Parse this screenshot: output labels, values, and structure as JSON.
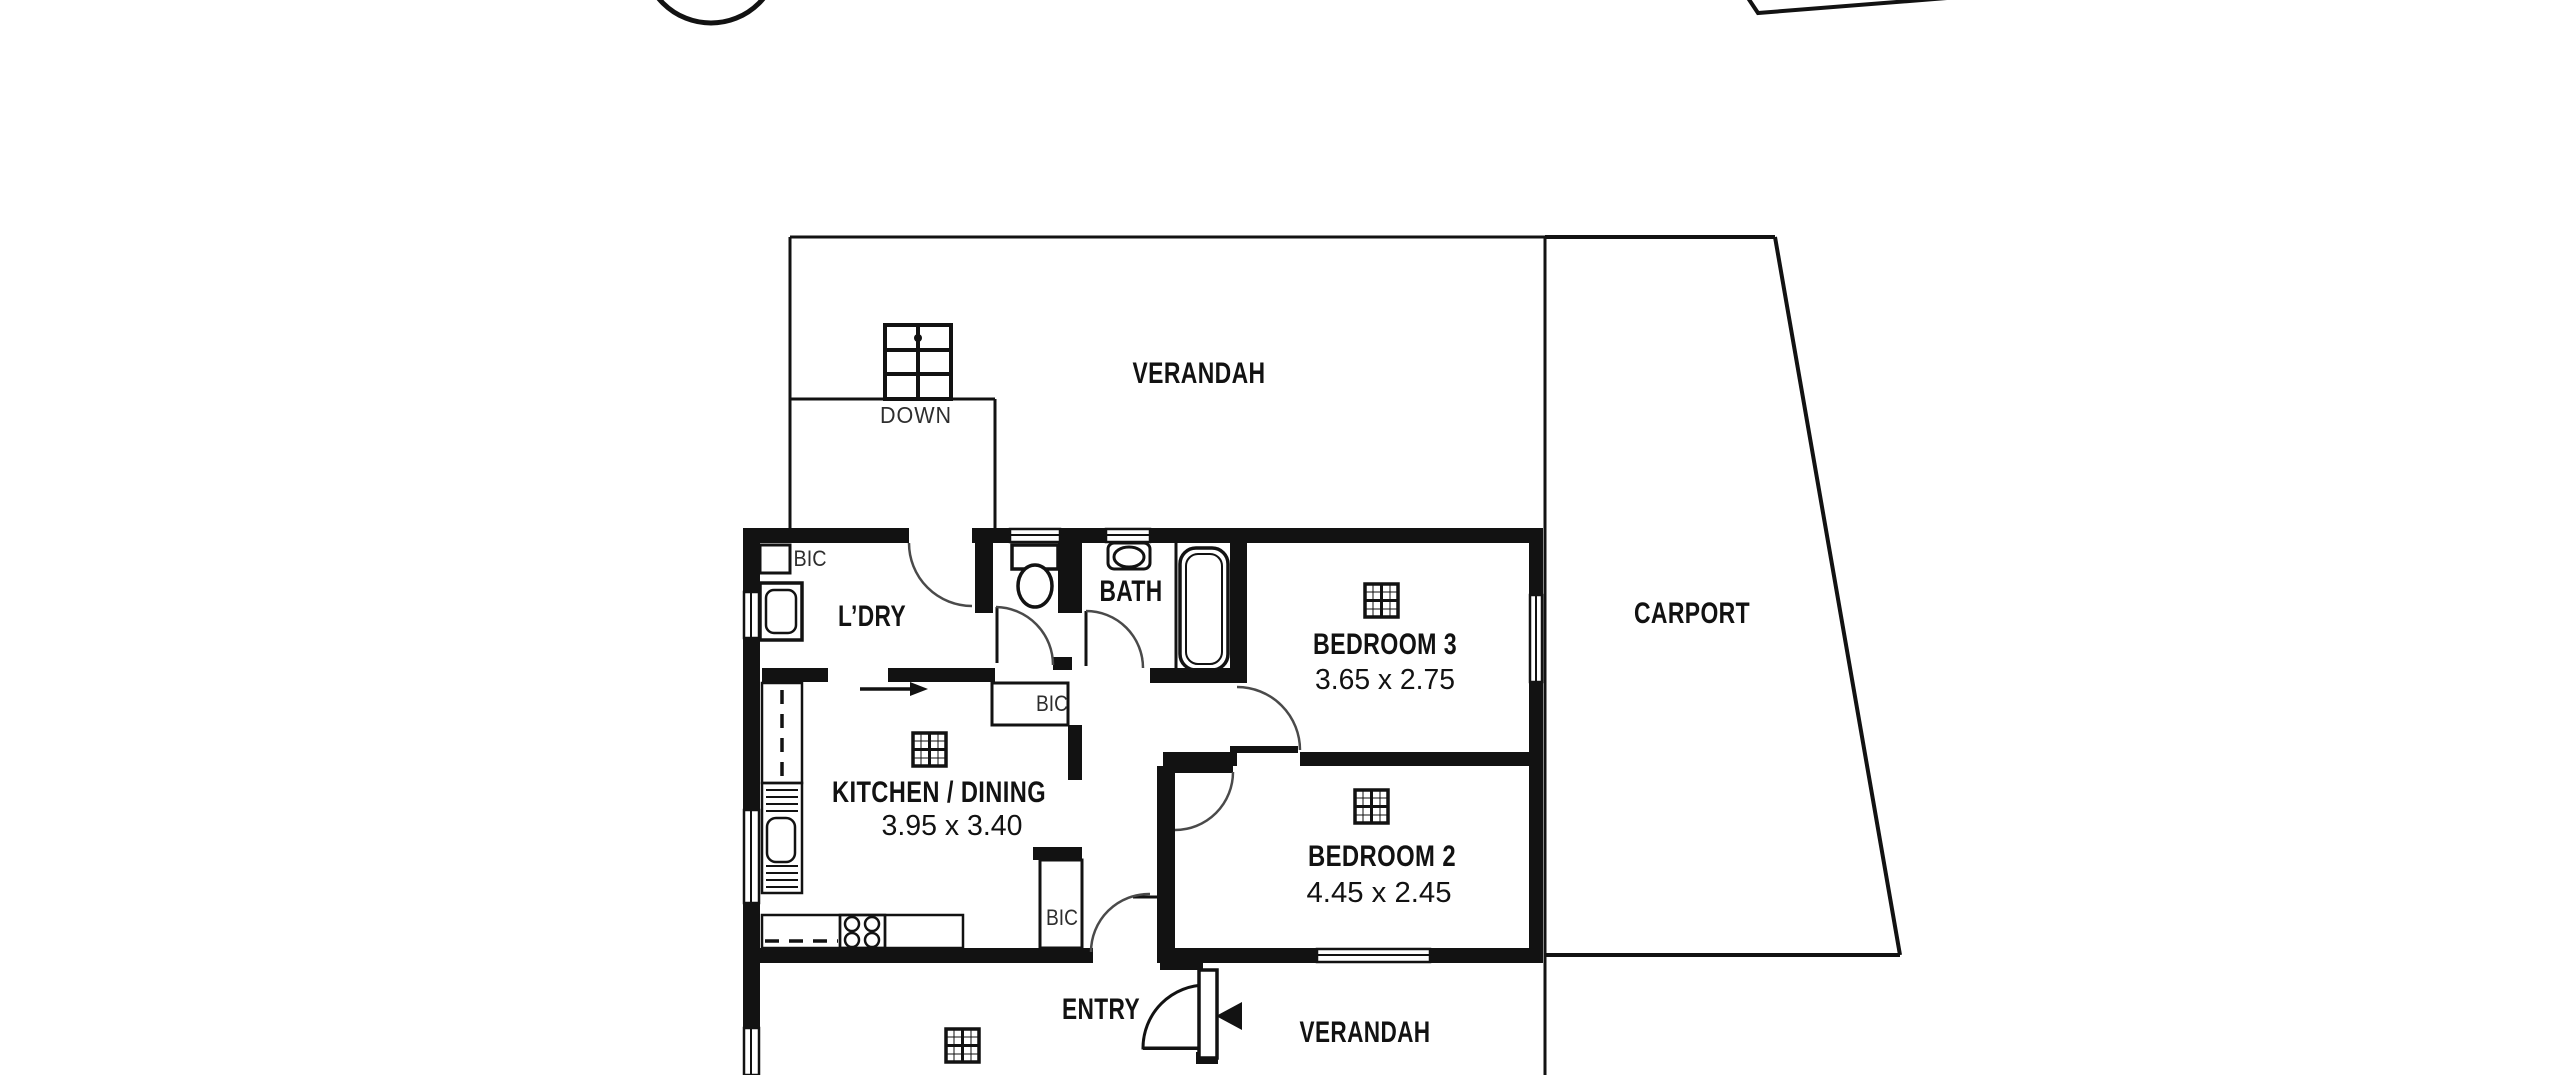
{
  "canvas": {
    "background": "#ffffff",
    "wall_color": "#121212",
    "door_arc_color": "#4a4a4a"
  },
  "areas": {
    "verandah_top": {
      "label": "VERANDAH"
    },
    "carport": {
      "label": "CARPORT"
    },
    "stairs": {
      "label": "DOWN"
    },
    "laundry": {
      "label": "L’DRY",
      "bic": "BIC"
    },
    "bath": {
      "label": "BATH"
    },
    "bedroom3": {
      "label": "BEDROOM 3",
      "dims": "3.65 x 2.75"
    },
    "kitchen_dining": {
      "label": "KITCHEN / DINING",
      "dims": "3.95 x 3.40"
    },
    "bedroom2": {
      "label": "BEDROOM 2",
      "dims": "4.45 x 2.45"
    },
    "hall": {
      "bic_linen": "BIC",
      "bic_robe": "BIC"
    },
    "entry": {
      "label": "ENTRY"
    },
    "verandah_bottom": {
      "label": "VERANDAH"
    }
  },
  "fixtures": [
    "stairs-icon",
    "toilet-icon",
    "basin-icon",
    "bathtub-icon",
    "laundry-tub-icon",
    "kitchen-sink-icon",
    "stove-icon",
    "ceiling-grid-icon",
    "door-swing-arc",
    "window-marker",
    "entry-direction-arrow",
    "flow-arrow",
    "compass-circle",
    "boundary-line"
  ]
}
